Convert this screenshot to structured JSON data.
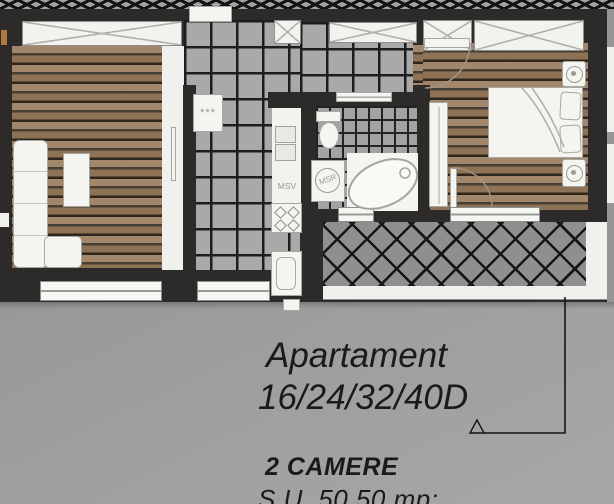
{
  "plan": {
    "labels": {
      "dishwasher": "MSV",
      "washing_machine": "MSR",
      "coat_hooks": "***"
    }
  },
  "caption": {
    "apartment_line1": "Apartament",
    "apartment_line2": "16/24/32/40D",
    "rooms": "2 CAMERE",
    "area": "S.U. 50,50 mp:"
  },
  "colors": {
    "wall": "#2d2b29",
    "wood_floor": "#97795a",
    "tile_floor": "#a9a9a9",
    "grout": "#1d1d1d",
    "balcony_lattice": "#8f8f8f",
    "furniture": "#f4f4f1",
    "background": "#9a9a9a",
    "caption_text": "#1a1a1a"
  }
}
